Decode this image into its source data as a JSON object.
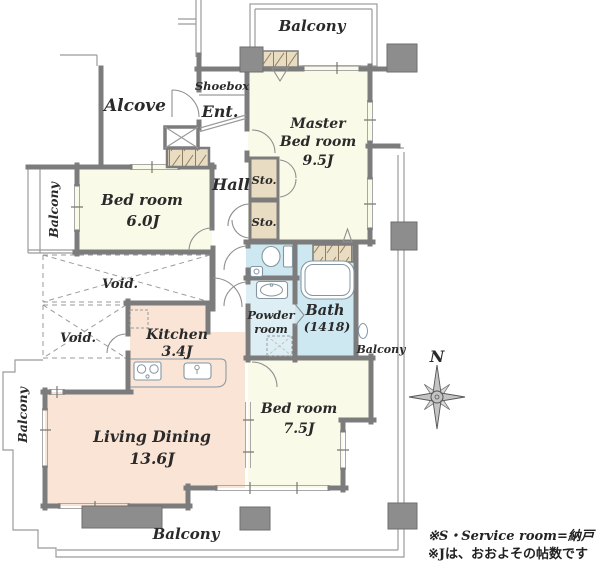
{
  "title": "Apartment floor plan",
  "balconies": {
    "top": "Balcony",
    "left_upper": "Balcony",
    "left_lower": "Balcony",
    "bottom": "Balcony",
    "right": "Balcony"
  },
  "rooms": {
    "alcove": "Alcove",
    "shoebox": "Shoebox",
    "entrance": "Ent.",
    "hall": "Hall",
    "master": {
      "l1": "Master",
      "l2": "Bed room",
      "size": "9.5J"
    },
    "bed6": {
      "l1": "Bed room",
      "size": "6.0J"
    },
    "bed7": {
      "l1": "Bed room",
      "size": "7.5J"
    },
    "living": {
      "l1": "Living Dining",
      "size": "13.6J"
    },
    "kitchen": {
      "l1": "Kitchen",
      "size": "3.4J"
    },
    "bath": {
      "l1": "Bath",
      "size": "(1418)"
    },
    "powder": {
      "l1": "Powder",
      "l2": "room"
    },
    "sto1": "Sto.",
    "sto2": "Sto.",
    "void1": "Void.",
    "void2": "Void."
  },
  "compass": {
    "n": "N"
  },
  "notes": {
    "line1": "※S・Service room=納戸",
    "line2": "※Jは、おおよその帖数です"
  },
  "colors": {
    "cream": "#fafae8",
    "salmon": "#f9e4d6",
    "wet_blue": "#cde8f0",
    "powder_blue": "#ddeef4",
    "tan": "#e8dcc2",
    "wall": "#7c7c7c",
    "column": "#8d8d8d"
  },
  "fixtures": [
    "toilet",
    "hand-basin",
    "vanity-sink",
    "washing-machine-pan",
    "bathtub",
    "gas-stove",
    "kitchen-sink",
    "refrigerator-space",
    "compass-rose"
  ]
}
